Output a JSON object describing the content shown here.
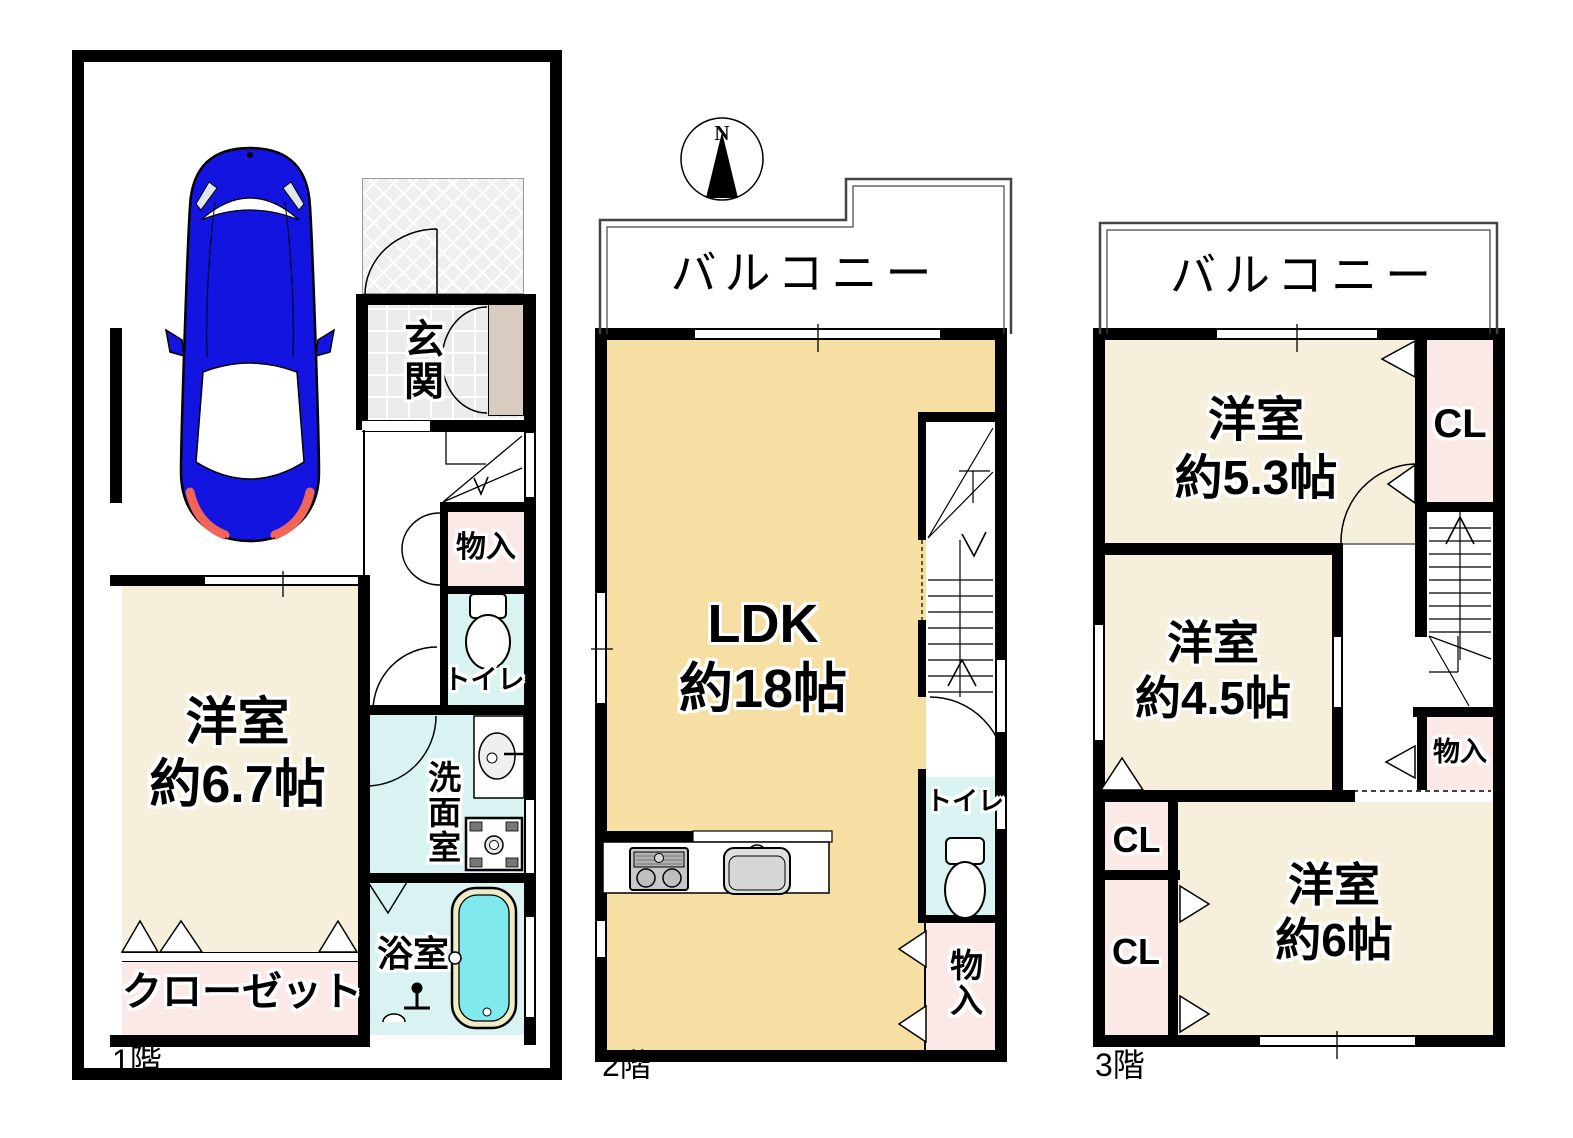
{
  "compass": {
    "north": "N"
  },
  "floor1": {
    "label": "1階",
    "rooms": {
      "genkan": "玄関",
      "storage": "物入",
      "toilet": "トイレ",
      "washroom": "洗面室",
      "bathroom": "浴室",
      "bedroom": {
        "name": "洋室",
        "size": "約6.7帖"
      },
      "closet": "クローゼット"
    }
  },
  "floor2": {
    "label": "2階",
    "balcony": "バルコニー",
    "rooms": {
      "ldk": {
        "name": "LDK",
        "size": "約18帖"
      },
      "toilet": "トイレ",
      "storage": "物入"
    }
  },
  "floor3": {
    "label": "3階",
    "balcony": "バルコニー",
    "rooms": {
      "bedroom53": {
        "name": "洋室",
        "size": "約5.3帖"
      },
      "closet1": "CL",
      "bedroom45": {
        "name": "洋室",
        "size": "約4.5帖"
      },
      "storage": "物入",
      "closet2": "CL",
      "closet3": "CL",
      "bedroom6": {
        "name": "洋室",
        "size": "約6帖"
      }
    }
  },
  "colors": {
    "wall": "#000000",
    "bedroom_floor": "#F5EFDC",
    "ldk_floor": "#F5DFA2",
    "closet_pink": "#FBE9E7",
    "wet_area_cyan": "#D9F3F3",
    "bath_water": "#7FE9EE",
    "car_blue": "#1414E0"
  }
}
